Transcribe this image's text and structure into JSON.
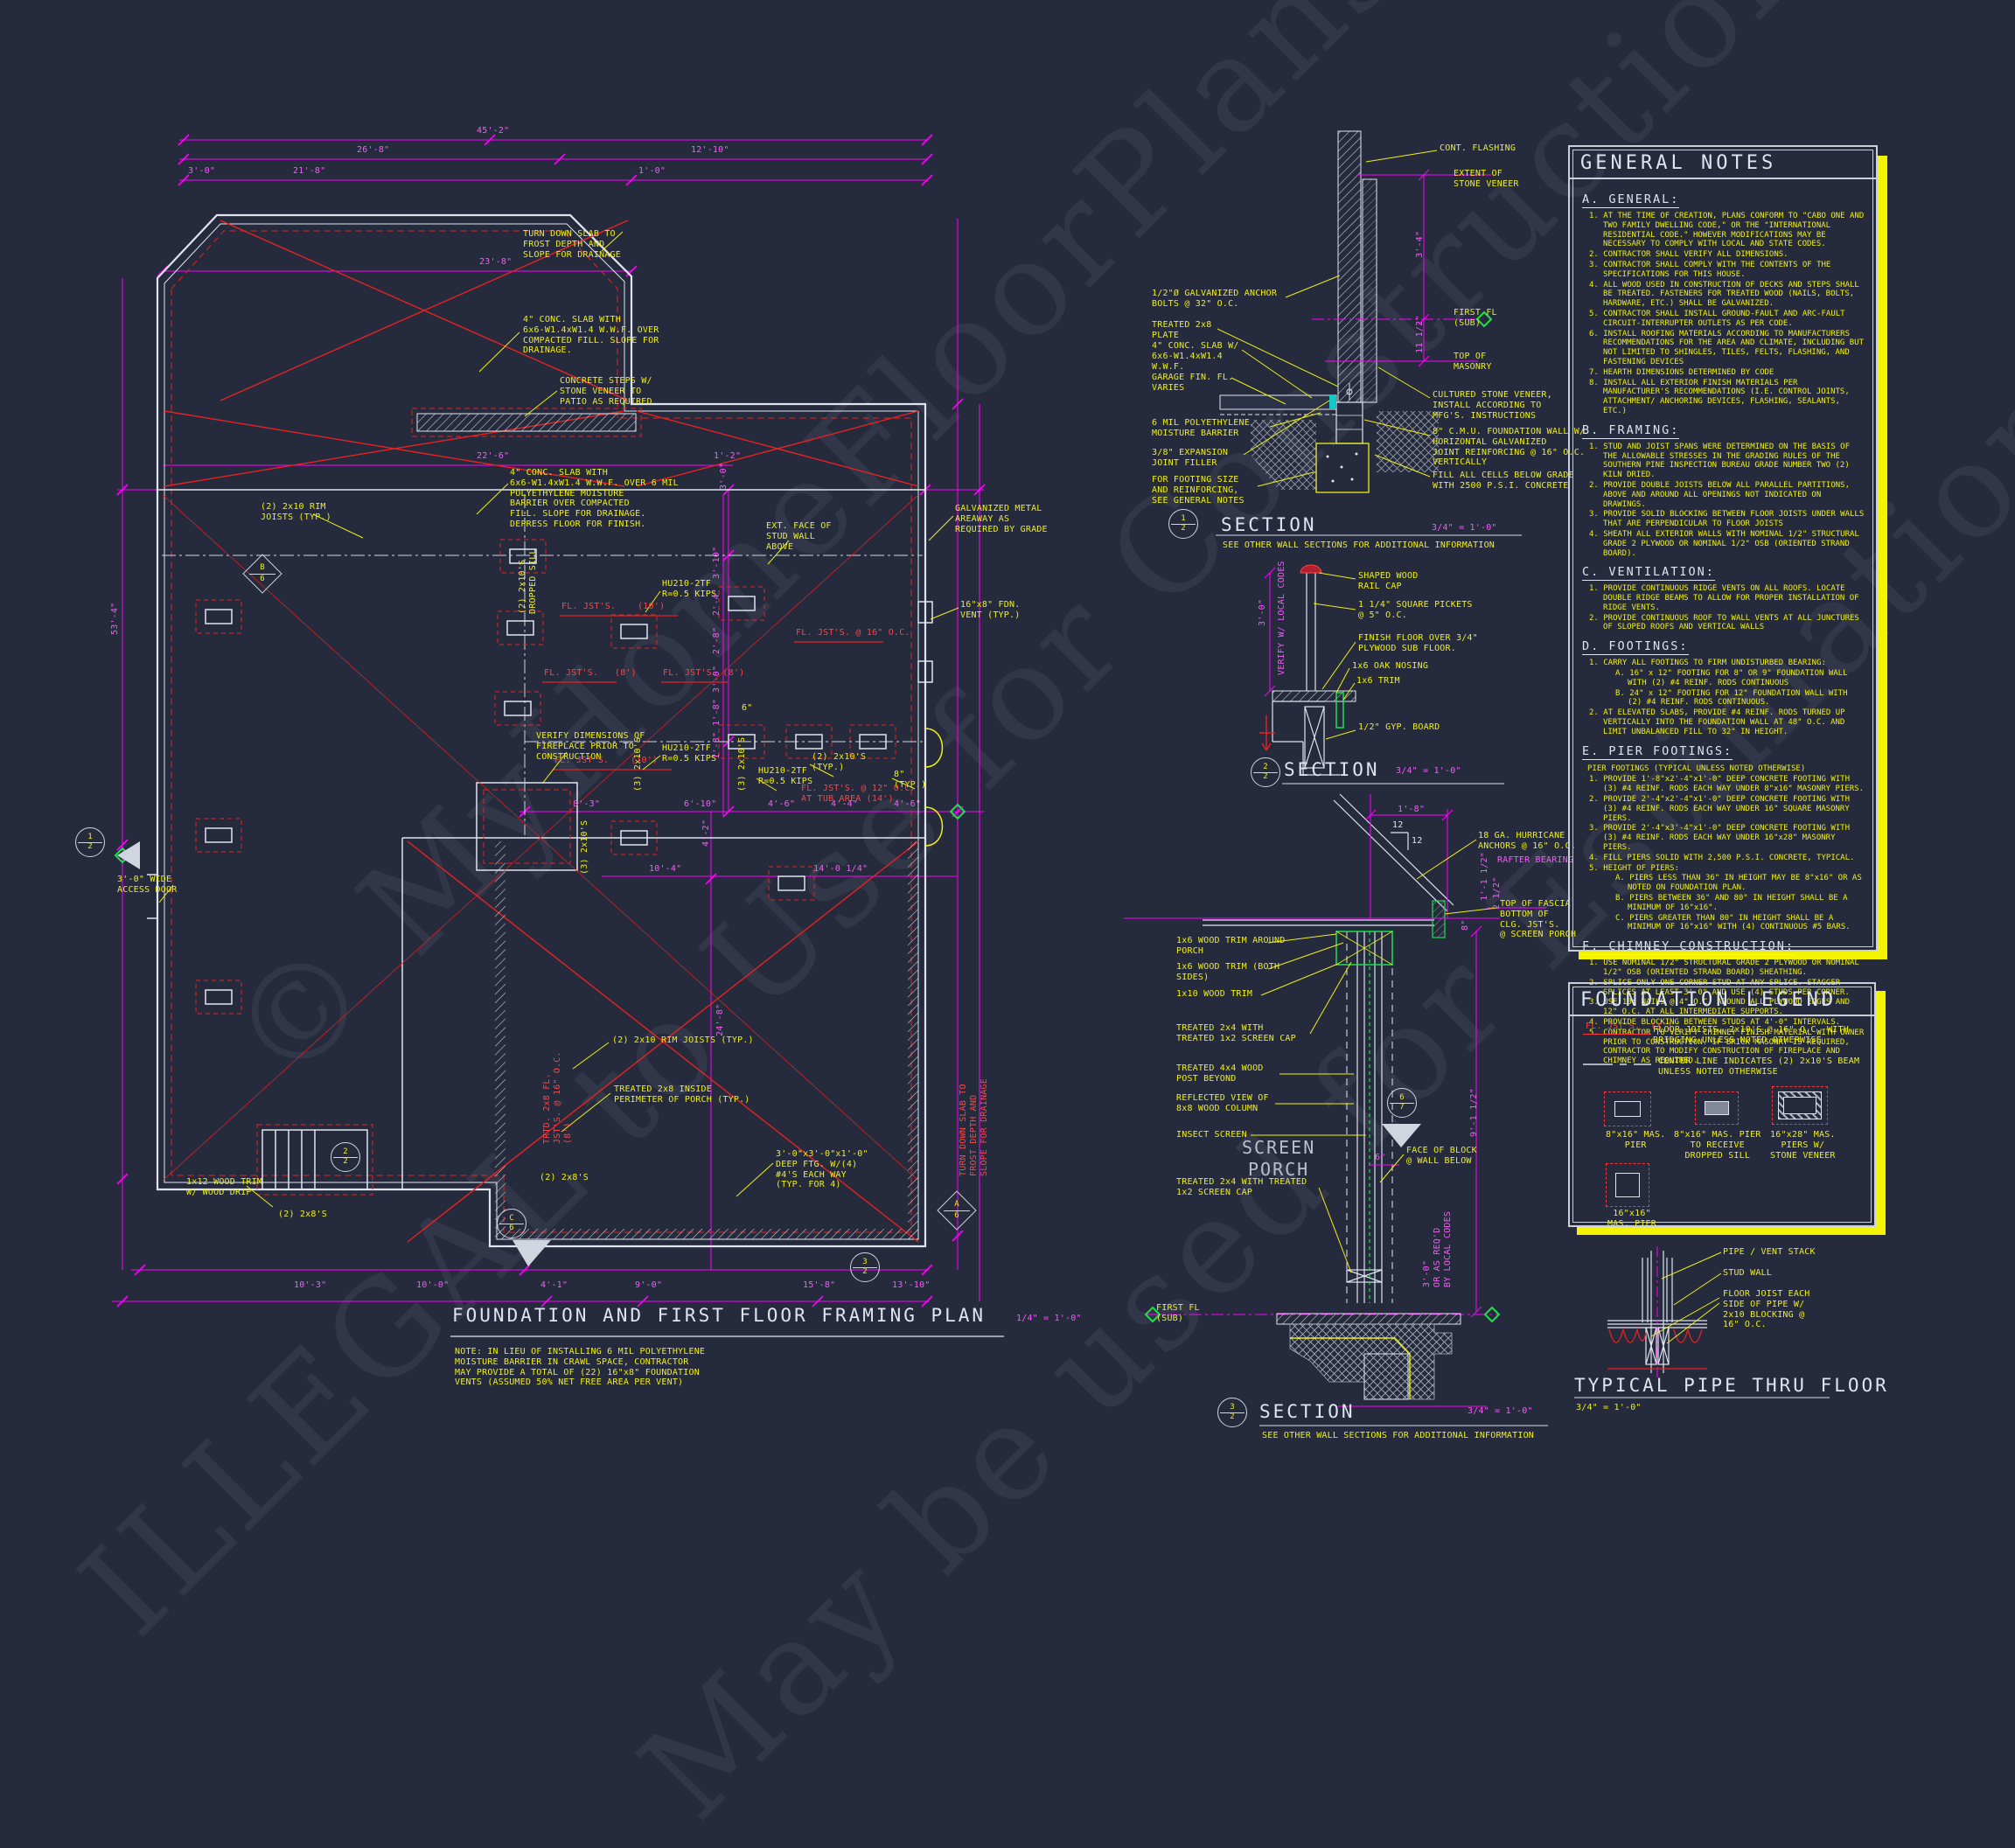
{
  "watermark": {
    "line1": "© MyHomeFloorPlans.com",
    "line2": "ILLEGAL to Use for Construction",
    "line3": "May be used for Estimation"
  },
  "plan": {
    "title": "FOUNDATION AND FIRST FLOOR FRAMING PLAN",
    "scale": "1/4\" = 1'-0\"",
    "note": "NOTE: IN LIEU OF INSTALLING 6 MIL POLYETHYLENE\nMOISTURE BARRIER IN CRAWL SPACE, CONTRACTOR\nMAY PROVIDE A TOTAL OF (22) 16\"x8\" FOUNDATION\nVENTS (ASSUMED 50% NET FREE AREA PER VENT)",
    "ann": {
      "a1": "TURN DOWN SLAB TO\nFROST DEPTH AND\nSLOPE FOR DRAINAGE",
      "a2": "4\" CONC. SLAB WITH\n6x6-W1.4xW1.4 W.W.F. OVER\nCOMPACTED FILL. SLOPE FOR\nDRAINAGE.",
      "a3": "CONCRETE STEPS W/\nSTONE VENEER TO\nPATIO AS REQUIRED",
      "a4": "4\" CONC. SLAB WITH\n6x6-W1.4xW1.4 W.W.F. OVER 6 MIL\nPOLYETHYLENE MOISTURE\nBARRIER OVER COMPACTED\nFILL. SLOPE FOR DRAINAGE.\nDEPRESS FLOOR FOR FINISH.",
      "a5": "(2) 2x10 RIM\nJOISTS (TYP.)",
      "a6": "EXT. FACE OF\nSTUD WALL\nABOVE",
      "a7": "GALVANIZED METAL\nAREAWAY AS\nREQUIRED BY GRADE",
      "a8": "16\"x8\" FDN.\nVENT (TYP.)",
      "a9": "HU210-2TF\nR=0.5 KIPS",
      "a10": "HU210-2TF\nR=0.5 KIPS",
      "a11": "HU210-2TF\nR=0.5 KIPS",
      "a12": "(2) 2x10'S\nDROPPED SILL",
      "a13": "VERIFY DIMENSIONS OF\nFIREPLACE PRIOR TO\nCONSTRUCTION",
      "a14": "(3) 2x10'S",
      "a15": "(3) 2x10'S",
      "a16": "(2) 2x10'S\n(TYP.)",
      "a17": "8\"\n(TYP.)",
      "a18": "(2) 2x10 RIM JOISTS (TYP.)",
      "a19": "TREATED 2x8 INSIDE\nPERIMETER OF PORCH (TYP.)",
      "a20": "(2) 2x8'S",
      "a21": "3'-0\"x3'-0\"x1'-0\"\nDEEP FTG. W/(4)\n#4'S EACH WAY\n(TYP. FOR 4)",
      "a22": "3'-0\" WIDE\nACCESS DOOR",
      "a23": "1x12 WOOD TRIM\nW/ WOOD DRIP",
      "a24": "(2) 2x8'S",
      "a25": "(3) 2x10'S",
      "a26": "6\""
    },
    "red": {
      "r1": "FL. JST'S.    (10')",
      "r2": "FL. JST'S.   (8')",
      "r3": "FL. JST'S. (8')",
      "r4": "FL. JST'S.    (10')",
      "r5": "FL. JST'S. @ 16\" O.C.",
      "r6": "FL. JST'S. @ 12\" O.C.\nAT TUB AREA (14')",
      "r7": "TRTD. 2x8 FL.\nJST'S. @ 16\" O.C.\n(8')",
      "r8": "TURN DOWN SLAB TO\nFROST DEPTH AND\nSLOPE FOR DRAINAGE"
    },
    "dim": {
      "d1": "45'-2\"",
      "d2": "26'-8\"",
      "d3": "12'-10\"",
      "d4": "3'-0\"",
      "d5": "21'-8\"",
      "d6": "1'-0\"",
      "d7": "23'-8\"",
      "d9": "22'-6\"",
      "d10": "1'-2\"",
      "d11": "3'-0\"",
      "d12": "8'-3\"",
      "d13": "6'-10\"",
      "d14": "4'-6\"",
      "d15": "4'-4\"",
      "d16": "4'-6\"",
      "d17": "10'-4\"",
      "d18": "14'-0 1/4\"",
      "d19": "24'-8\"",
      "d20": "4'-1\"",
      "d21": "9'-0\"",
      "d22": "15'-8\"",
      "d23": "53'-4\"",
      "d24": "10'-3\"",
      "d25": "10'-0\"",
      "d26": "13'-10\"",
      "d27": "3'-10\"",
      "d28": "2'-4\"",
      "d29": "2'-8\"",
      "d30": "3'-0\"",
      "d31": "1'-8\"",
      "d32": "1'-8\"",
      "d33": "4'-2\""
    },
    "markers": {
      "m12": {
        "t": "1",
        "b": "2"
      },
      "m22": {
        "t": "2",
        "b": "2"
      },
      "m32": {
        "t": "3",
        "b": "2"
      },
      "mb6": {
        "t": "B",
        "b": "6"
      },
      "mc6": {
        "t": "C",
        "b": "6"
      },
      "ma6": {
        "t": "A",
        "b": "6"
      }
    }
  },
  "s1": {
    "num": "1",
    "sheet": "2",
    "title": "SECTION",
    "sub": "SEE OTHER WALL SECTIONS FOR ADDITIONAL INFORMATION",
    "scale": "3/4\" = 1'-0\"",
    "l1": "1/2\"Ø GALVANIZED ANCHOR\nBOLTS @ 32\" O.C.",
    "l2": "TREATED 2x8\nPLATE",
    "l3": "4\" CONC. SLAB W/\n6x6-W1.4xW1.4\nW.W.F.",
    "l4": "GARAGE FIN. FL.\nVARIES",
    "l5": "6 MIL POLYETHYLENE\nMOISTURE BARRIER",
    "l6": "3/8\" EXPANSION\nJOINT FILLER",
    "l7": "FOR FOOTING SIZE\nAND REINFORCING,\nSEE GENERAL NOTES",
    "r1": "CONT. FLASHING",
    "r2": "EXTENT OF\nSTONE VENEER",
    "r3": "FIRST FL\n(SUB)",
    "r4": "TOP OF\nMASONRY",
    "r5": "CULTURED STONE VENEER,\nINSTALL ACCORDING TO\nMFG'S. INSTRUCTIONS",
    "r6": "8\" C.M.U. FOUNDATION WALL W/\nHORIZONTAL GALVANIZED\nJOINT REINFORCING @ 16\" O.C.\nVERTICALLY",
    "r7": "FILL ALL CELLS BELOW GRADE\nWITH 2500 P.S.I. CONCRETE",
    "d1": "3'-4\"",
    "d2": "11 1/2\""
  },
  "s2": {
    "num": "2",
    "sheet": "2",
    "title": "SECTION",
    "scale": "3/4\" = 1'-0\"",
    "m1": "3'-0\"",
    "m2": "VERIFY W/ LOCAL CODES",
    "l1": "SHAPED WOOD\nRAIL CAP",
    "l2": "1 1/4\" SQUARE PICKETS\n@ 5\" O.C.",
    "l3": "FINISH FLOOR OVER 3/4\"\nPLYWOOD SUB FLOOR.",
    "l4": "1x6 OAK NOSING",
    "l5": "1x6 TRIM",
    "l6": "1/2\" GYP. BOARD"
  },
  "s3": {
    "num": "3",
    "sheet": "2",
    "title": "SECTION",
    "sub": "SEE OTHER WALL SECTIONS FOR ADDITIONAL INFORMATION",
    "scale": "3/4\" = 1'-0\"",
    "t1": "1x6 WOOD TRIM AROUND\nPORCH",
    "t2": "1x6 WOOD TRIM (BOTH\nSIDES)",
    "t3": "1x10 WOOD TRIM",
    "t4": "TREATED 2x4 WITH\nTREATED 1x2 SCREEN CAP",
    "t5": "TREATED 4x4 WOOD\nPOST BEYOND",
    "t6": "REFLECTED VIEW OF\n8x8 WOOD COLUMN",
    "t7": "INSECT SCREEN",
    "t8": "SCREEN\nPORCH",
    "t9": "TREATED 2x4 WITH TREATED\n1x2 SCREEN CAP",
    "t10": "FIRST FL\n(SUB)",
    "u1": "18 GA. HURRICANE\nANCHORS @ 16\" O.C.",
    "u2": "RAFTER BEARING",
    "u3": "TOP OF FASCIA\nBOTTOM OF\nCLG. JST'S.\n@ SCREEN PORCH",
    "u4": "FACE OF BLOCK\n@ WALL BELOW",
    "d1": "1'-8\"",
    "d2": "12",
    "d3": "12",
    "d4": "1'-1 1/2\"",
    "d5": "2 1/2\"",
    "d6": "8\"",
    "d7": "6\"",
    "d8": "9'-1 1/2\"",
    "d9": "3'-0\"\nOR AS REQ'D\nBY LOCAL CODES",
    "marker": {
      "t": "6",
      "b": "7"
    }
  },
  "pipe": {
    "title": "TYPICAL PIPE THRU FLOOR",
    "scale": "3/4\" = 1'-0\"",
    "label_pipe": "PIPE / VENT STACK",
    "label_stud": "STUD WALL",
    "label_joist": "FLOOR JOIST EACH\nSIDE OF PIPE W/\n2x10 BLOCKING @\n16\" O.C."
  },
  "notes": {
    "title": "GENERAL NOTES",
    "a_heading": "A. GENERAL:",
    "a": [
      "1. AT THE TIME OF CREATION, PLANS CONFORM TO \"CABO ONE AND TWO FAMILY DWELLING CODE,\" OR THE \"INTERNATIONAL RESIDENTIAL CODE.\" HOWEVER MODIFICATIONS MAY BE NECESSARY TO COMPLY WITH LOCAL AND STATE CODES.",
      "2. CONTRACTOR SHALL VERIFY ALL DIMENSIONS.",
      "3. CONTRACTOR SHALL COMPLY WITH THE CONTENTS OF THE SPECIFICATIONS FOR THIS HOUSE.",
      "4. ALL WOOD USED IN CONSTRUCTION OF DECKS AND STEPS SHALL BE TREATED.  FASTENERS FOR TREATED WOOD (NAILS, BOLTS, HARDWARE, ETC.) SHALL BE GALVANIZED.",
      "5. CONTRACTOR SHALL INSTALL GROUND-FAULT AND ARC-FAULT CIRCUIT-INTERRUPTER OUTLETS AS PER CODE.",
      "6. INSTALL ROOFING MATERIALS ACCORDING TO MANUFACTURERS RECOMMENDATIONS FOR THE AREA AND CLIMATE, INCLUDING BUT NOT LIMITED TO  SHINGLES, TILES, FELTS, FLASHING, AND FASTENING DEVICES",
      "7. HEARTH DIMENSIONS DETERMINED BY CODE",
      "8. INSTALL ALL EXTERIOR FINISH MATERIALS PER MANUFACTURER'S RECOMMENDATIONS (I.E. CONTROL JOINTS, ATTACHMENT/ ANCHORING DEVICES, FLASHING, SEALANTS, ETC.)"
    ],
    "b_heading": "B. FRAMING:",
    "b": [
      "1. STUD AND JOIST SPANS WERE DETERMINED ON THE BASIS OF THE ALLOWABLE STRESSES IN THE GRADING RULES OF THE SOUTHERN PINE INSPECTION BUREAU GRADE NUMBER TWO (2) KILN DRIED.",
      "2. PROVIDE DOUBLE JOISTS BELOW ALL PARALLEL PARTITIONS, ABOVE AND AROUND ALL OPENINGS NOT INDICATED ON DRAWINGS.",
      "3. PROVIDE SOLID BLOCKING BETWEEN FLOOR JOISTS UNDER WALLS THAT ARE PERPENDICULAR TO FLOOR JOISTS",
      "4. SHEATH ALL EXTERIOR WALLS WITH NOMINAL 1/2\" STRUCTURAL GRADE 2 PLYWOOD OR NOMINAL 1/2\" OSB (ORIENTED STRAND BOARD)."
    ],
    "c_heading": "C. VENTILATION:",
    "c": [
      "1. PROVIDE CONTINUOUS RIDGE VENTS ON ALL ROOFS. LOCATE DOUBLE RIDGE BEAMS TO ALLOW FOR PROPER INSTALLATION OF RIDGE VENTS.",
      "2. PROVIDE CONTINUOUS ROOF TO WALL VENTS AT ALL JUNCTURES OF SLOPED ROOFS AND VERTICAL WALLS"
    ],
    "d_heading": "D. FOOTINGS:",
    "d": [
      "1. CARRY ALL FOOTINGS TO FIRM UNDISTURBED BEARING:",
      "A. 16\" x 12\" FOOTING FOR 8\" OR 9\" FOUNDATION WALL WITH (2) #4 REINF. RODS CONTINUOUS",
      "B. 24\" x 12\" FOOTING FOR 12\" FOUNDATION WALL WITH (2) #4 REINF. RODS CONTINUOUS.",
      "2. AT ELEVATED SLABS, PROVIDE #4 REINF. RODS TURNED UP VERTICALLY INTO THE FOUNDATION WALL AT 48\" O.C. AND LIMIT UNBALANCED FILL TO 32\" IN HEIGHT."
    ],
    "e_heading": "E. PIER FOOTINGS:",
    "e_intro": "PIER FOOTINGS (TYPICAL UNLESS NOTED OTHERWISE)",
    "e": [
      "1. PROVIDE 1'-8\"x2'-4\"x1'-0\" DEEP CONCRETE FOOTING WITH (3) #4 REINF. RODS EACH WAY UNDER 8\"x16\" MASONRY PIERS.",
      "2. PROVIDE 2'-4\"x2'-4\"x1'-0\" DEEP CONCRETE FOOTING WITH (3) #4 REINF. RODS EACH WAY UNDER 16\" SQUARE MASONRY PIERS.",
      "3. PROVIDE 2'-4\"x3'-4\"x1'-0\" DEEP CONCRETE FOOTING WITH (3) #4 REINF. RODS EACH WAY UNDER 16\"x28\" MASONRY PIERS.",
      "4. FILL PIERS SOLID WITH 2,500 P.S.I. CONCRETE, TYPICAL.",
      "5. HEIGHT OF PIERS:",
      "A. PIERS LESS THAN 36\" IN HEIGHT MAY BE 8\"x16\" OR AS NOTED ON FOUNDATION PLAN.",
      "B. PIERS BETWEEN 36\" AND 80\" IN HEIGHT SHALL BE A MINIMUM OF 16\"x16\".",
      "C. PIERS GREATER THAN 80\" IN HEIGHT SHALL BE A MINIMUM OF 16\"x16\" WITH (4) CONTINUOUS #5 BARS."
    ],
    "f_heading": "F. CHIMNEY CONSTRUCTION:",
    "f": [
      "1. USE NOMINAL 1/2\" STRUCTURAL GRADE 2 PLYWOOD OR NOMINAL 1/2\" OSB (ORIENTED STRAND BOARD) SHEATHING.",
      "2. SPLICE ONLY ONE CORNER STUD AT ANY SPLICE.  STAGGER SPLICES AT LEAST 3'-0\" AND USE (4) STUDS PER CORNER.",
      "3. USE 10d NAILS @ 4\" O.C. AROUND ALL PLYWOOD EDGES AND 12\" O.C. AT ALL INTERMEDIATE SUPPORTS.",
      "4. PROVIDE BLOCKING BETWEEN STUDS AT 4'-0\" INTERVALS.",
      "5. CONTRACTOR TO VERIFY CHIMNEY FINISH MATERIAL WITH OWNER PRIOR TO CONSTRUCTION. IF BRICK MASONRY IS REQUIRED, CONTRACTOR TO MODIFY  CONSTRUCTION OF FIREPLACE AND CHIMNEY AS REQUIRED."
    ]
  },
  "legend": {
    "title": "FOUNDATION LEGEND",
    "joist_symbol": "FL. JST'S.  (X')",
    "joist_text": "FLOOR JOISTS, 2x10'S @ 16\" O.C. WITH\nBRIDGING UNLESS NOTED OTHERWISE",
    "center_text": "CENTER LINE INDICATES (2) 2x10'S BEAM\nUNLESS NOTED OTHERWISE",
    "pier1": "8\"x16\" MAS.\nPIER",
    "pier2": "8\"x16\" MAS. PIER\nTO RECEIVE\nDROPPED SILL",
    "pier3": "16\"x28\" MAS.\nPIERS W/\nSTONE VENEER",
    "pier4": "16\"x16\"\nMAS. PIER"
  }
}
